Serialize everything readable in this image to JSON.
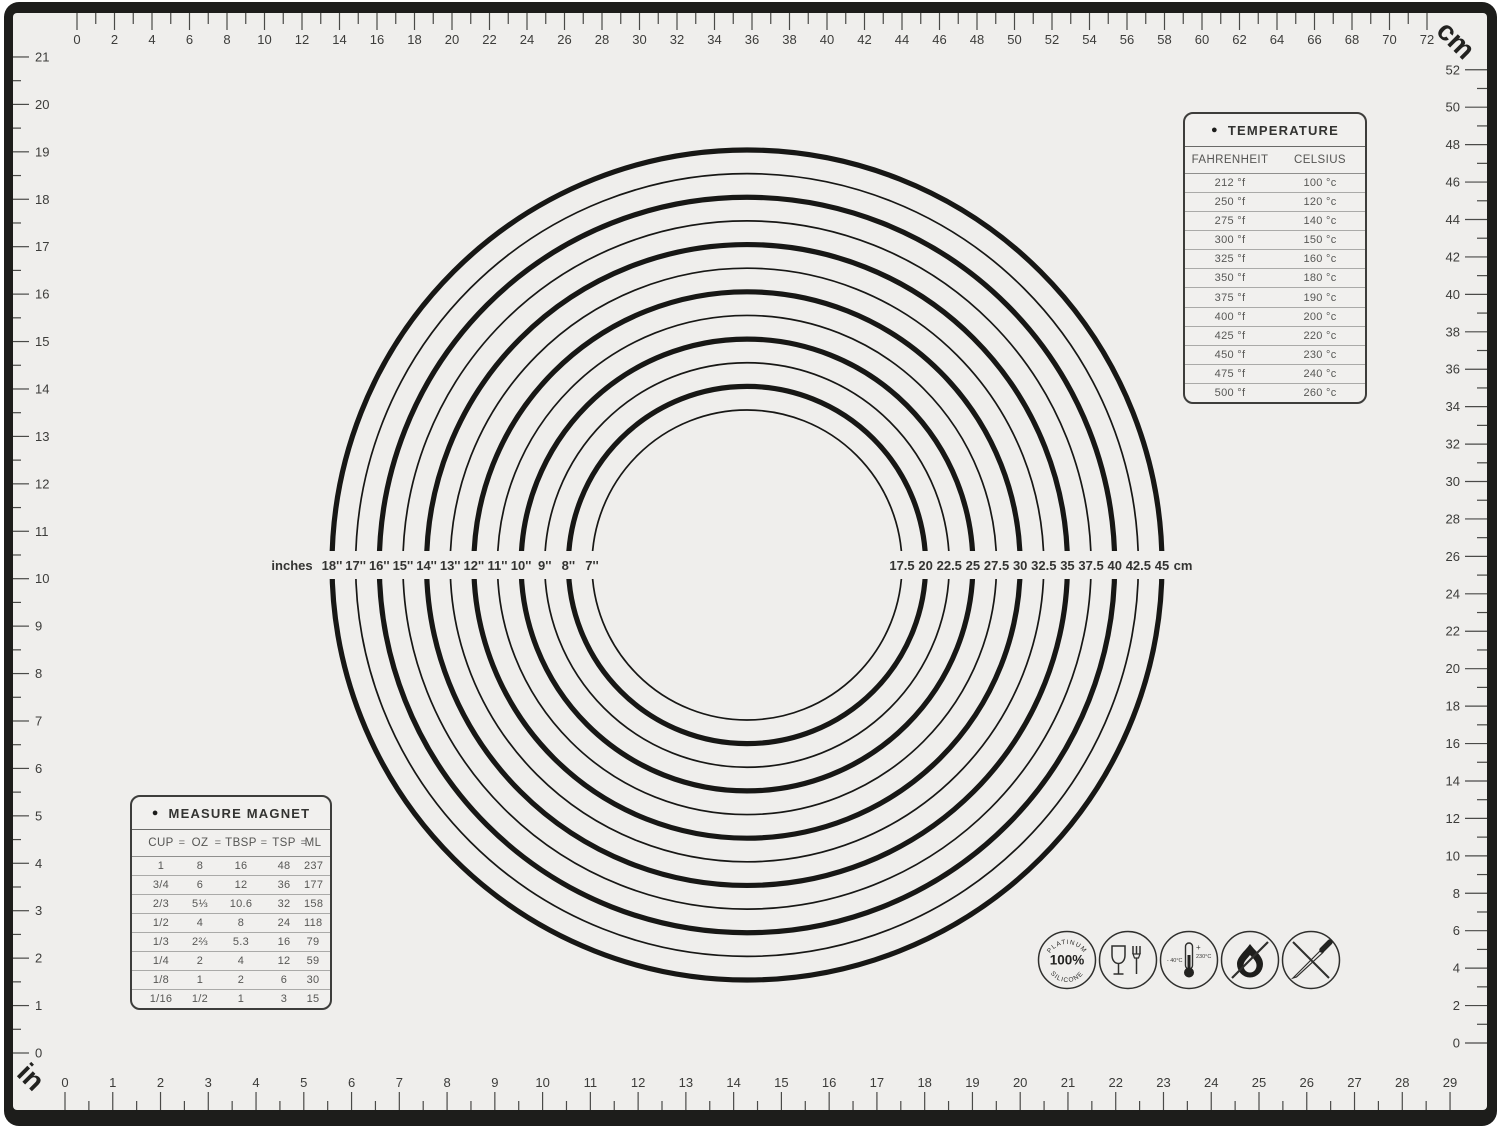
{
  "rulers": {
    "top": {
      "unit": "cm",
      "start": 0,
      "end": 72,
      "label_step": 2,
      "corner_label": "cm"
    },
    "bottom": {
      "unit": "in",
      "start": 0,
      "end": 29,
      "label_step": 1,
      "corner_label": "in"
    },
    "left": {
      "unit": "in",
      "start": 0,
      "end": 21,
      "label_step": 1
    },
    "right": {
      "unit": "cm",
      "start": 0,
      "end": 52,
      "label_step": 2
    }
  },
  "circle_guide": {
    "prefix_label": "inches",
    "suffix_label": "cm",
    "inch_labels": [
      "18''",
      "17''",
      "16''",
      "15''",
      "14''",
      "13''",
      "12''",
      "11''",
      "10''",
      "9''",
      "8''",
      "7''"
    ],
    "cm_labels": [
      "17.5",
      "20",
      "22.5",
      "25",
      "27.5",
      "30",
      "32.5",
      "35",
      "37.5",
      "40",
      "42.5",
      "45"
    ]
  },
  "temperature_panel": {
    "bullet": "●",
    "title": "TEMPERATURE",
    "columns": [
      "FAHRENHEIT",
      "CELSIUS"
    ],
    "rows": [
      [
        "212 °f",
        "100 °c"
      ],
      [
        "250 °f",
        "120 °c"
      ],
      [
        "275 °f",
        "140 °c"
      ],
      [
        "300 °f",
        "150 °c"
      ],
      [
        "325 °f",
        "160 °c"
      ],
      [
        "350 °f",
        "180 °c"
      ],
      [
        "375 °f",
        "190 °c"
      ],
      [
        "400 °f",
        "200 °c"
      ],
      [
        "425 °f",
        "220 °c"
      ],
      [
        "450 °f",
        "230 °c"
      ],
      [
        "475 °f",
        "240 °c"
      ],
      [
        "500 °f",
        "260 °c"
      ]
    ]
  },
  "measure_panel": {
    "bullet": "●",
    "title": "MEASURE MAGNET",
    "equals": "=",
    "units": [
      "CUP",
      "OZ",
      "TBSP",
      "TSP",
      "ML"
    ],
    "rows": [
      [
        "1",
        "8",
        "16",
        "48",
        "237"
      ],
      [
        "3/4",
        "6",
        "12",
        "36",
        "177"
      ],
      [
        "2/3",
        "5⅓",
        "10.6",
        "32",
        "158"
      ],
      [
        "1/2",
        "4",
        "8",
        "24",
        "118"
      ],
      [
        "1/3",
        "2⅔",
        "5.3",
        "16",
        "79"
      ],
      [
        "1/4",
        "2",
        "4",
        "12",
        "59"
      ],
      [
        "1/8",
        "1",
        "2",
        "6",
        "30"
      ],
      [
        "1/16",
        "1/2",
        "1",
        "3",
        "15"
      ]
    ]
  },
  "icons": {
    "platinum": {
      "arc_top": "PLATINUM",
      "center": "100%",
      "arc_bottom": "SILICONE"
    },
    "temperature_range": {
      "min": "- 40°C",
      "plus": "+",
      "max": "230°C"
    }
  },
  "colors": {
    "mat": "#efeeec",
    "frame": "#1d1d1b",
    "ink": "#3c3c3a",
    "circle": "#171715"
  }
}
